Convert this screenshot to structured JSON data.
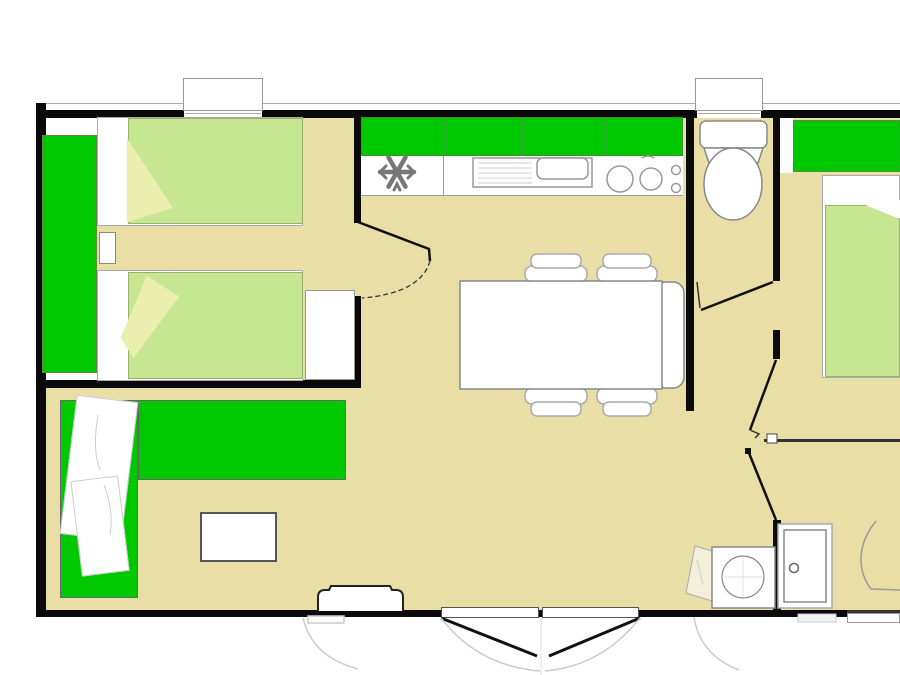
{
  "meta": {
    "type": "floor-plan",
    "subject": "mobile-home-floor-plan-top-view",
    "canvas_width": 900,
    "canvas_height": 675
  },
  "palette": {
    "floor": "#E9DFA6",
    "green": "#00C800",
    "bed-green": "#C7E692",
    "pillow": "#EAEFB0",
    "towel": "#F3F0DA",
    "wall": "#0A0A0A",
    "line": "#888888",
    "white": "#FFFFFF"
  },
  "rooms": [
    {
      "id": "bedroom-1",
      "desc": "twin-bed bedroom with wardrobe, left side"
    },
    {
      "id": "kitchen",
      "desc": "kitchen strip with fridge, sink, hob and upper cabinets"
    },
    {
      "id": "dining-area",
      "desc": "dining table with four chairs and bench"
    },
    {
      "id": "living-area",
      "desc": "L-shaped sofa with coffee table"
    },
    {
      "id": "wc",
      "desc": "separate toilet room, top right"
    },
    {
      "id": "bedroom-2",
      "desc": "double-bed bedroom with wardrobe, right side (cut by image edge)"
    },
    {
      "id": "shower-room",
      "desc": "bottom-right room with washbasin and shower cabinet"
    }
  ],
  "fixtures": [
    "wardrobe",
    "single-bed",
    "pillow",
    "nightstand",
    "upper-cabinets",
    "fridge-freezer",
    "sink-with-drainer",
    "hob-two-burners",
    "toilet",
    "dining-table",
    "bench-seat",
    "dining-chair",
    "corner-sofa",
    "throw-blanket",
    "coffee-table",
    "double-bed",
    "washbasin",
    "towel",
    "shower-cabinet",
    "entry-step",
    "french-double-door",
    "window",
    "door-swing"
  ]
}
